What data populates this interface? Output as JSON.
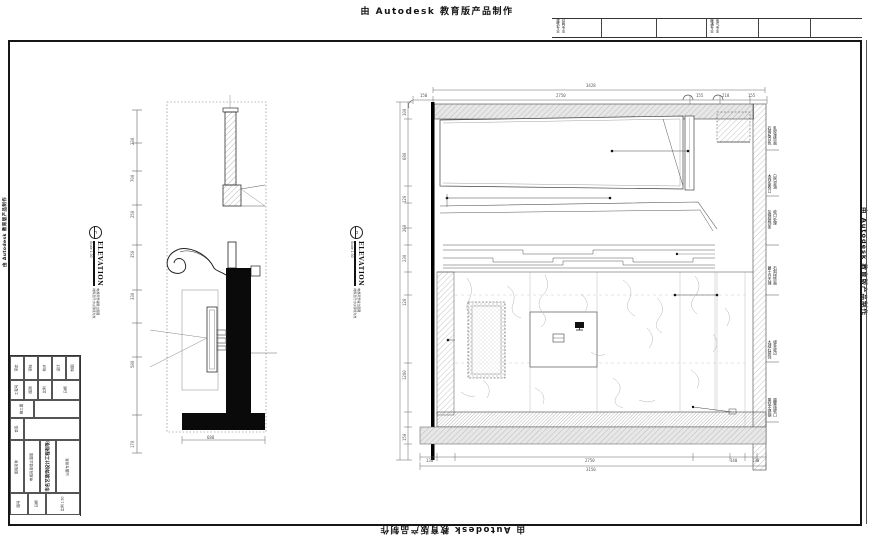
{
  "stamp": {
    "text": "由 Autodesk 教育版产品制作"
  },
  "header_strip": {
    "cells": [
      {
        "x": 556,
        "a": "建筑专业",
        "b": "结构专业"
      },
      {
        "x": 710,
        "a": "暖通专业",
        "b": "电气专业"
      }
    ]
  },
  "title_block": {
    "cells": [
      {
        "x": 0,
        "y": 1,
        "w": 14,
        "h": 24,
        "t": "审定"
      },
      {
        "x": 14,
        "y": 1,
        "w": 14,
        "h": 24,
        "t": "审核"
      },
      {
        "x": 28,
        "y": 1,
        "w": 14,
        "h": 24,
        "t": "校对"
      },
      {
        "x": 42,
        "y": 1,
        "w": 14,
        "h": 24,
        "t": "设计"
      },
      {
        "x": 56,
        "y": 1,
        "w": 14,
        "h": 24,
        "t": "制图"
      },
      {
        "x": 0,
        "y": 25,
        "w": 14,
        "h": 20,
        "t": "工程号"
      },
      {
        "x": 14,
        "y": 25,
        "w": 14,
        "h": 20,
        "t": "图别"
      },
      {
        "x": 28,
        "y": 25,
        "w": 14,
        "h": 20,
        "t": "比例"
      },
      {
        "x": 42,
        "y": 25,
        "w": 28,
        "h": 20,
        "t": "日期"
      },
      {
        "x": 0,
        "y": 45,
        "w": 24,
        "h": 18,
        "t": "施工图"
      },
      {
        "x": 24,
        "y": 45,
        "w": 46,
        "h": 18,
        "t": ""
      },
      {
        "x": 0,
        "y": 63,
        "w": 14,
        "h": 22,
        "t": "会签"
      },
      {
        "x": 14,
        "y": 63,
        "w": 56,
        "h": 22,
        "t": ""
      },
      {
        "x": 0,
        "y": 85,
        "w": 14,
        "h": 53,
        "t": "图纸名称"
      },
      {
        "x": 14,
        "y": 85,
        "w": 16,
        "h": 53,
        "t": "电视背景墙立面图"
      },
      {
        "x": 30,
        "y": 85,
        "w": 16,
        "h": 53,
        "t": "广州市名艺装饰设计工程有限公司",
        "big": true
      },
      {
        "x": 46,
        "y": 85,
        "w": 24,
        "h": 53,
        "t": "出图专用章"
      },
      {
        "x": 0,
        "y": 138,
        "w": 18,
        "h": 22,
        "t": "图号"
      },
      {
        "x": 18,
        "y": 138,
        "w": 18,
        "h": 22,
        "t": "日期"
      },
      {
        "x": 36,
        "y": 138,
        "w": 34,
        "h": 22,
        "t": "比例 1:30"
      }
    ]
  },
  "elevation_labels": {
    "left": {
      "letter": "C",
      "title": "ELEVATION",
      "scale": "Scale 1:30",
      "note1": "电视背景墙侧立面图",
      "note2": "材料及尺寸以现场为准"
    },
    "right": {
      "letter": "D",
      "title": "ELEVATION",
      "scale": "Scale 1:30",
      "note1": "电视背景墙立面图",
      "note2": "材料及尺寸以现场为准"
    }
  },
  "left_elevation": {
    "dims": [
      {
        "x": 131,
        "y": 145,
        "v": "230"
      },
      {
        "x": 131,
        "y": 182,
        "v": "700"
      },
      {
        "x": 131,
        "y": 218,
        "v": "250"
      },
      {
        "x": 131,
        "y": 258,
        "v": "350"
      },
      {
        "x": 131,
        "y": 300,
        "v": "330"
      },
      {
        "x": 131,
        "y": 368,
        "v": "580"
      },
      {
        "x": 131,
        "y": 448,
        "v": "170"
      }
    ],
    "base_dim": {
      "v": "680"
    }
  },
  "right_elevation": {
    "top_total": {
      "v": "3428"
    },
    "top_dims": [
      {
        "x": 420,
        "y": 94,
        "v": "150"
      },
      {
        "x": 556,
        "y": 94,
        "v": "2750"
      },
      {
        "x": 696,
        "y": 94,
        "v": "155"
      },
      {
        "x": 722,
        "y": 94,
        "v": "218"
      },
      {
        "x": 748,
        "y": 94,
        "v": "155"
      }
    ],
    "bottom_total": {
      "v": "3150"
    },
    "bottom_dims": [
      {
        "x": 426,
        "y": 459,
        "v": "130"
      },
      {
        "x": 585,
        "y": 459,
        "v": "2750"
      },
      {
        "x": 730,
        "y": 459,
        "v": "140"
      },
      {
        "x": 752,
        "y": 459,
        "v": "130"
      }
    ],
    "left_dims": [
      {
        "x": 403,
        "y": 116,
        "v": "100"
      },
      {
        "x": 403,
        "y": 160,
        "v": "680"
      },
      {
        "x": 403,
        "y": 203,
        "v": "120"
      },
      {
        "x": 403,
        "y": 232,
        "v": "260"
      },
      {
        "x": 403,
        "y": 262,
        "v": "230"
      },
      {
        "x": 403,
        "y": 306,
        "v": "120"
      },
      {
        "x": 403,
        "y": 380,
        "v": "1200"
      },
      {
        "x": 403,
        "y": 441,
        "v": "150"
      }
    ],
    "callouts": [
      {
        "x": 768,
        "y": 126,
        "a": "石膏板白色",
        "b": "乳胶漆饰面"
      },
      {
        "x": 768,
        "y": 174,
        "a": "木线条收口",
        "b": "白色混油"
      },
      {
        "x": 768,
        "y": 210,
        "a": "灰镜装饰条",
        "b": "收口处理"
      },
      {
        "x": 768,
        "y": 266,
        "a": "爵士白大理",
        "b": "石斜拼饰面"
      },
      {
        "x": 768,
        "y": 340,
        "a": "大理石装饰",
        "b": "线条收边"
      },
      {
        "x": 768,
        "y": 398,
        "a": "黑钛不锈钢",
        "b": "踢脚线收口"
      }
    ]
  }
}
